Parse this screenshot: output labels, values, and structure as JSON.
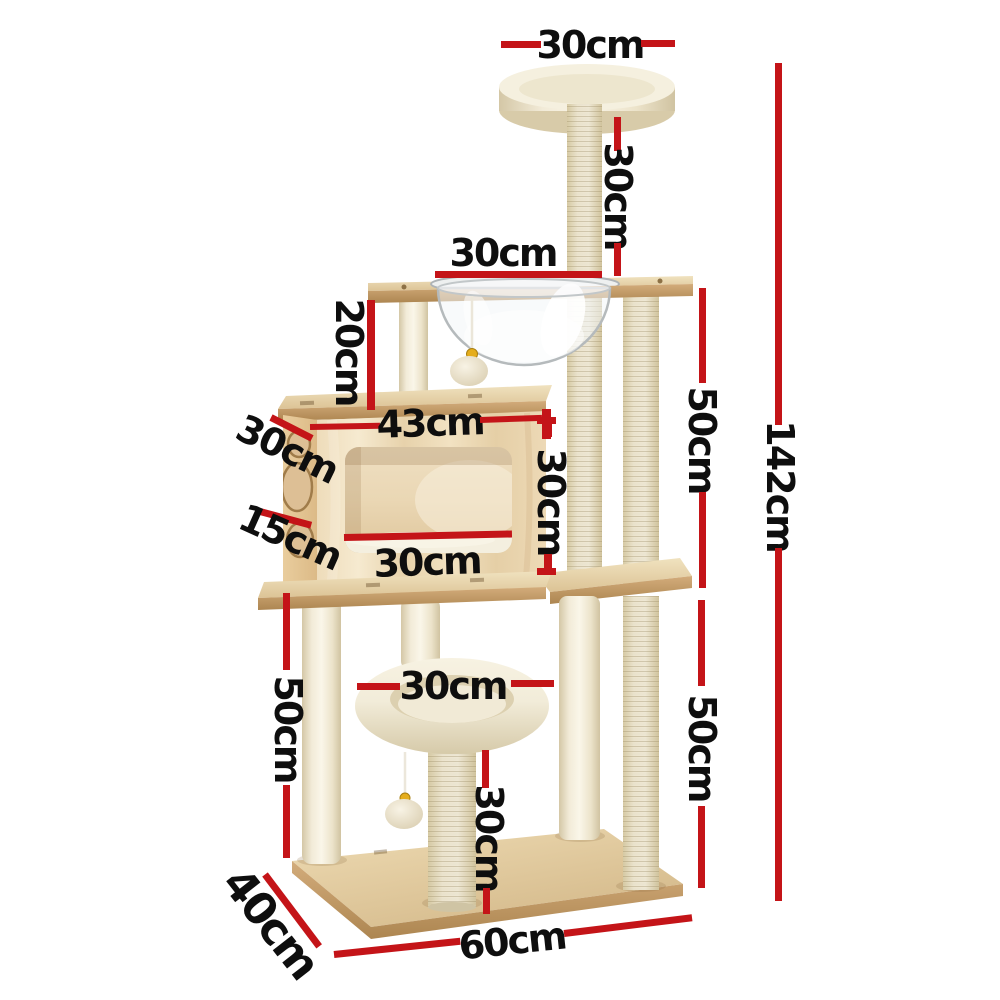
{
  "page": {
    "title": "Cat tree dimension diagram",
    "background": "#ffffff"
  },
  "colors": {
    "accent": "#c41418",
    "text": "#0e0e0e"
  },
  "dims": {
    "top_bed_width": "30cm",
    "top_post_height": "30cm",
    "top_platform_width": "30cm",
    "left_upper_post_height": "20cm",
    "condo_width": "43cm",
    "condo_depth": "30cm",
    "condo_height": "30cm",
    "condo_left_height": "15cm",
    "condo_opening_width": "30cm",
    "right_upper_section_height": "50cm",
    "left_lower_section_height": "50cm",
    "low_bed_width": "30cm",
    "low_post_height": "30cm",
    "right_lower_section_height": "50cm",
    "total_height": "142cm",
    "base_depth": "40cm",
    "base_width": "60cm"
  }
}
